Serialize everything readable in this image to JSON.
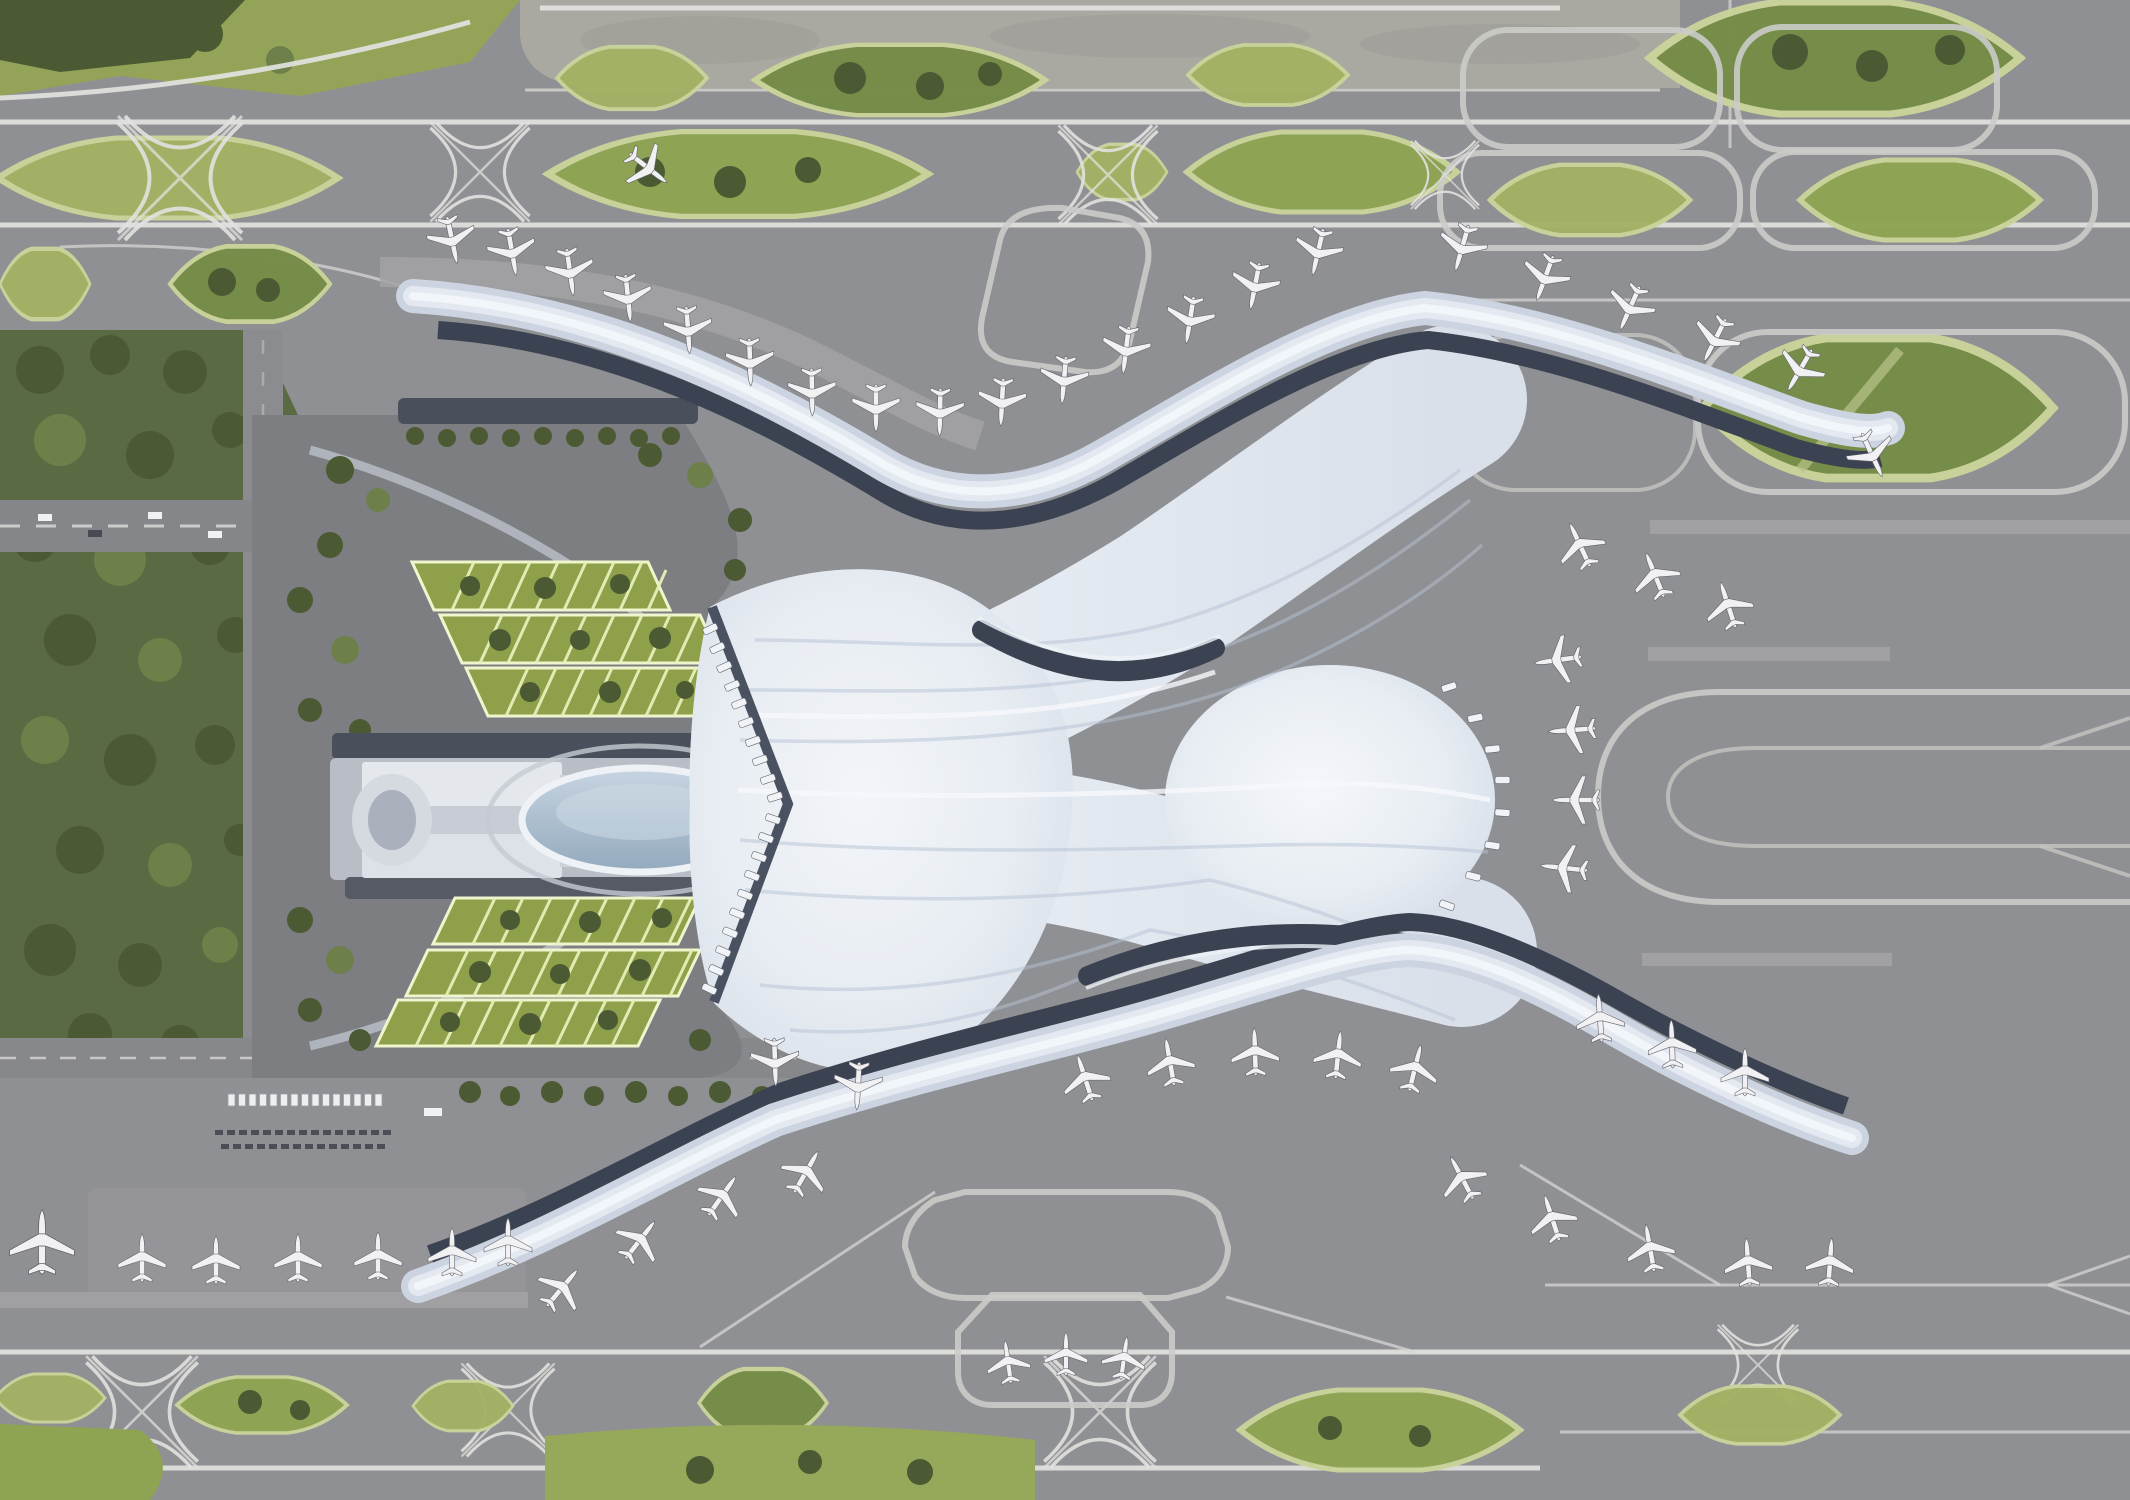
{
  "meta": {
    "title": "Airport terminal master plan — aerial rendering",
    "description": "Top-down architectural rendering of an airport: a white twin-lobed terminal with flowing ribbed roof and four curved piers lined with parked aircraft, a ground transportation centre with oval glass roof, two green-roofed parking structures, tree-lined landside roads, and a surrounding grid of runways, taxiways and green infield islands."
  },
  "colors": {
    "base_gray": "#8f9093",
    "pale_runway_strip": "#a9a8a1",
    "corridor_line": "#e2e2e0",
    "loop_line": "#cbcbc9",
    "green_light": "#a3b264",
    "green_mid": "#8ea452",
    "green_dark": "#768c47",
    "tree_dark": "#4b5a33",
    "forest": "#5a6a42",
    "parking_grid": "#e7efb8",
    "canyon_navy": "#3b4251",
    "pier_ribbon": "#ccd4e1",
    "pier_ribbon_hi": "#f2f5f9",
    "roof_white": "#e8ecf2",
    "roof_rib": "#b6c2d4",
    "glass_oval": "#a9bcce",
    "gtc_slab": "#b9bec6",
    "forecourt": "#7d7e82",
    "road": "#87888c",
    "aircraft": "#f1f1f3",
    "apron_light": "#a2a2a4"
  },
  "scene": {
    "terminal": {
      "aria": "Twin-lobed terminal with flowing ribbed white roof, four curved piers and dark curbside canyons",
      "piers": 4,
      "roof_lobes": 2,
      "curbside_canyons": 4
    },
    "landside": {
      "aria": "Landside area: ground transportation centre with oval glass roof, two green-roofed parking structures, forest belt and access roads",
      "parking_structures": 2,
      "parking_terraces_each": 3,
      "bus_shelters": 15,
      "parked_vehicle_rows": 2
    },
    "airside": {
      "aria": "Airside: runway and taxiway corridors with green infield islands, holding bays and apron stands",
      "green_islands": 21,
      "crossing_motifs": 8,
      "holding_bays": 2,
      "racetrack_loops": 1
    },
    "aircraft": {
      "aria": "Parked and taxiing aircraft",
      "count": 58
    },
    "jet_bridges": {
      "count": 28
    }
  }
}
